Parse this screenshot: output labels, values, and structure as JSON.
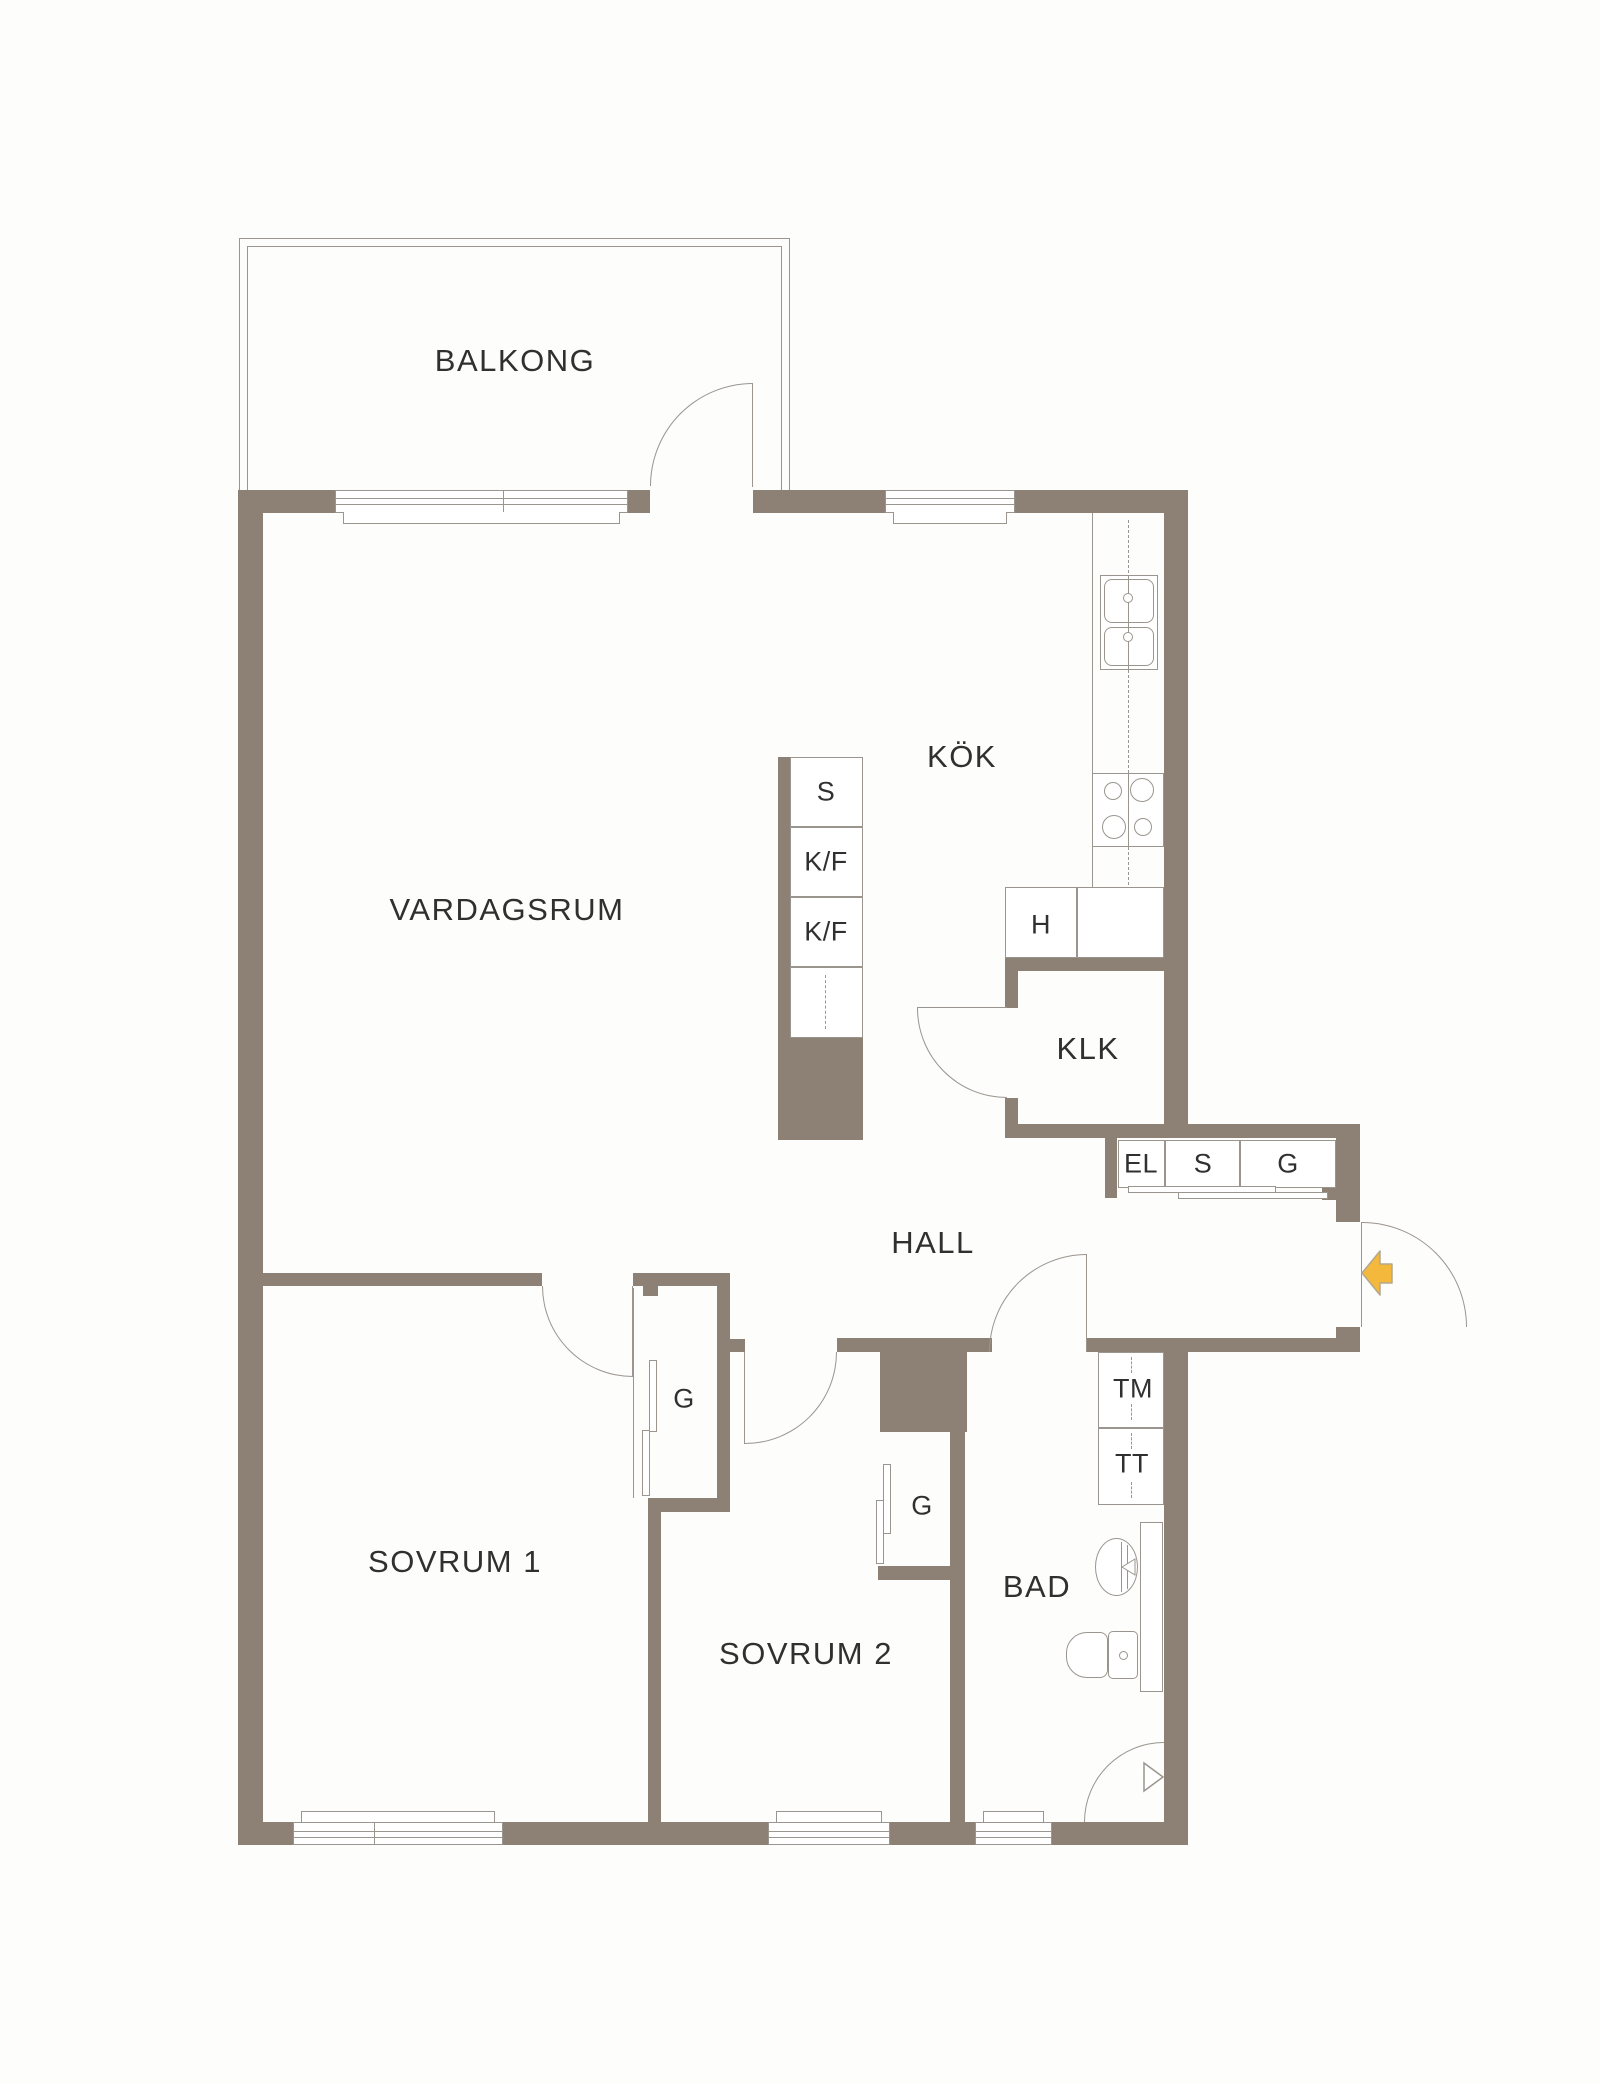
{
  "floorplan": {
    "rooms": {
      "balcony": "BALKONG",
      "living_room": "VARDAGSRUM",
      "kitchen": "KÖK",
      "walk_in_closet": "KLK",
      "hall": "HALL",
      "bedroom_1": "SOVRUM 1",
      "bedroom_2": "SOVRUM 2",
      "bathroom": "BAD"
    },
    "fixtures": {
      "cleaning_cabinet": "S",
      "fridge_freezer": "K/F",
      "appliance_hob": "H",
      "electrical_cabinet": "EL",
      "wardrobe": "G",
      "washing_machine": "TM",
      "tumble_dryer": "TT"
    },
    "icons": {
      "entry_arrow": "entry-direction-arrow",
      "kitchen_sink": "double-sink-icon",
      "hob": "stove-hob-icon",
      "bathroom_basin": "washbasin-icon",
      "toilet": "toilet-icon",
      "shower": "shower-corner-icon",
      "door": "door-swing-icon",
      "window": "window-icon",
      "wardrobe_doors": "folding-door-icon"
    },
    "colors": {
      "wall": "#8C8174",
      "line": "#9A958E",
      "text": "#303030",
      "entry_arrow": "#F4B83C",
      "background": "#FDFDFB"
    }
  }
}
